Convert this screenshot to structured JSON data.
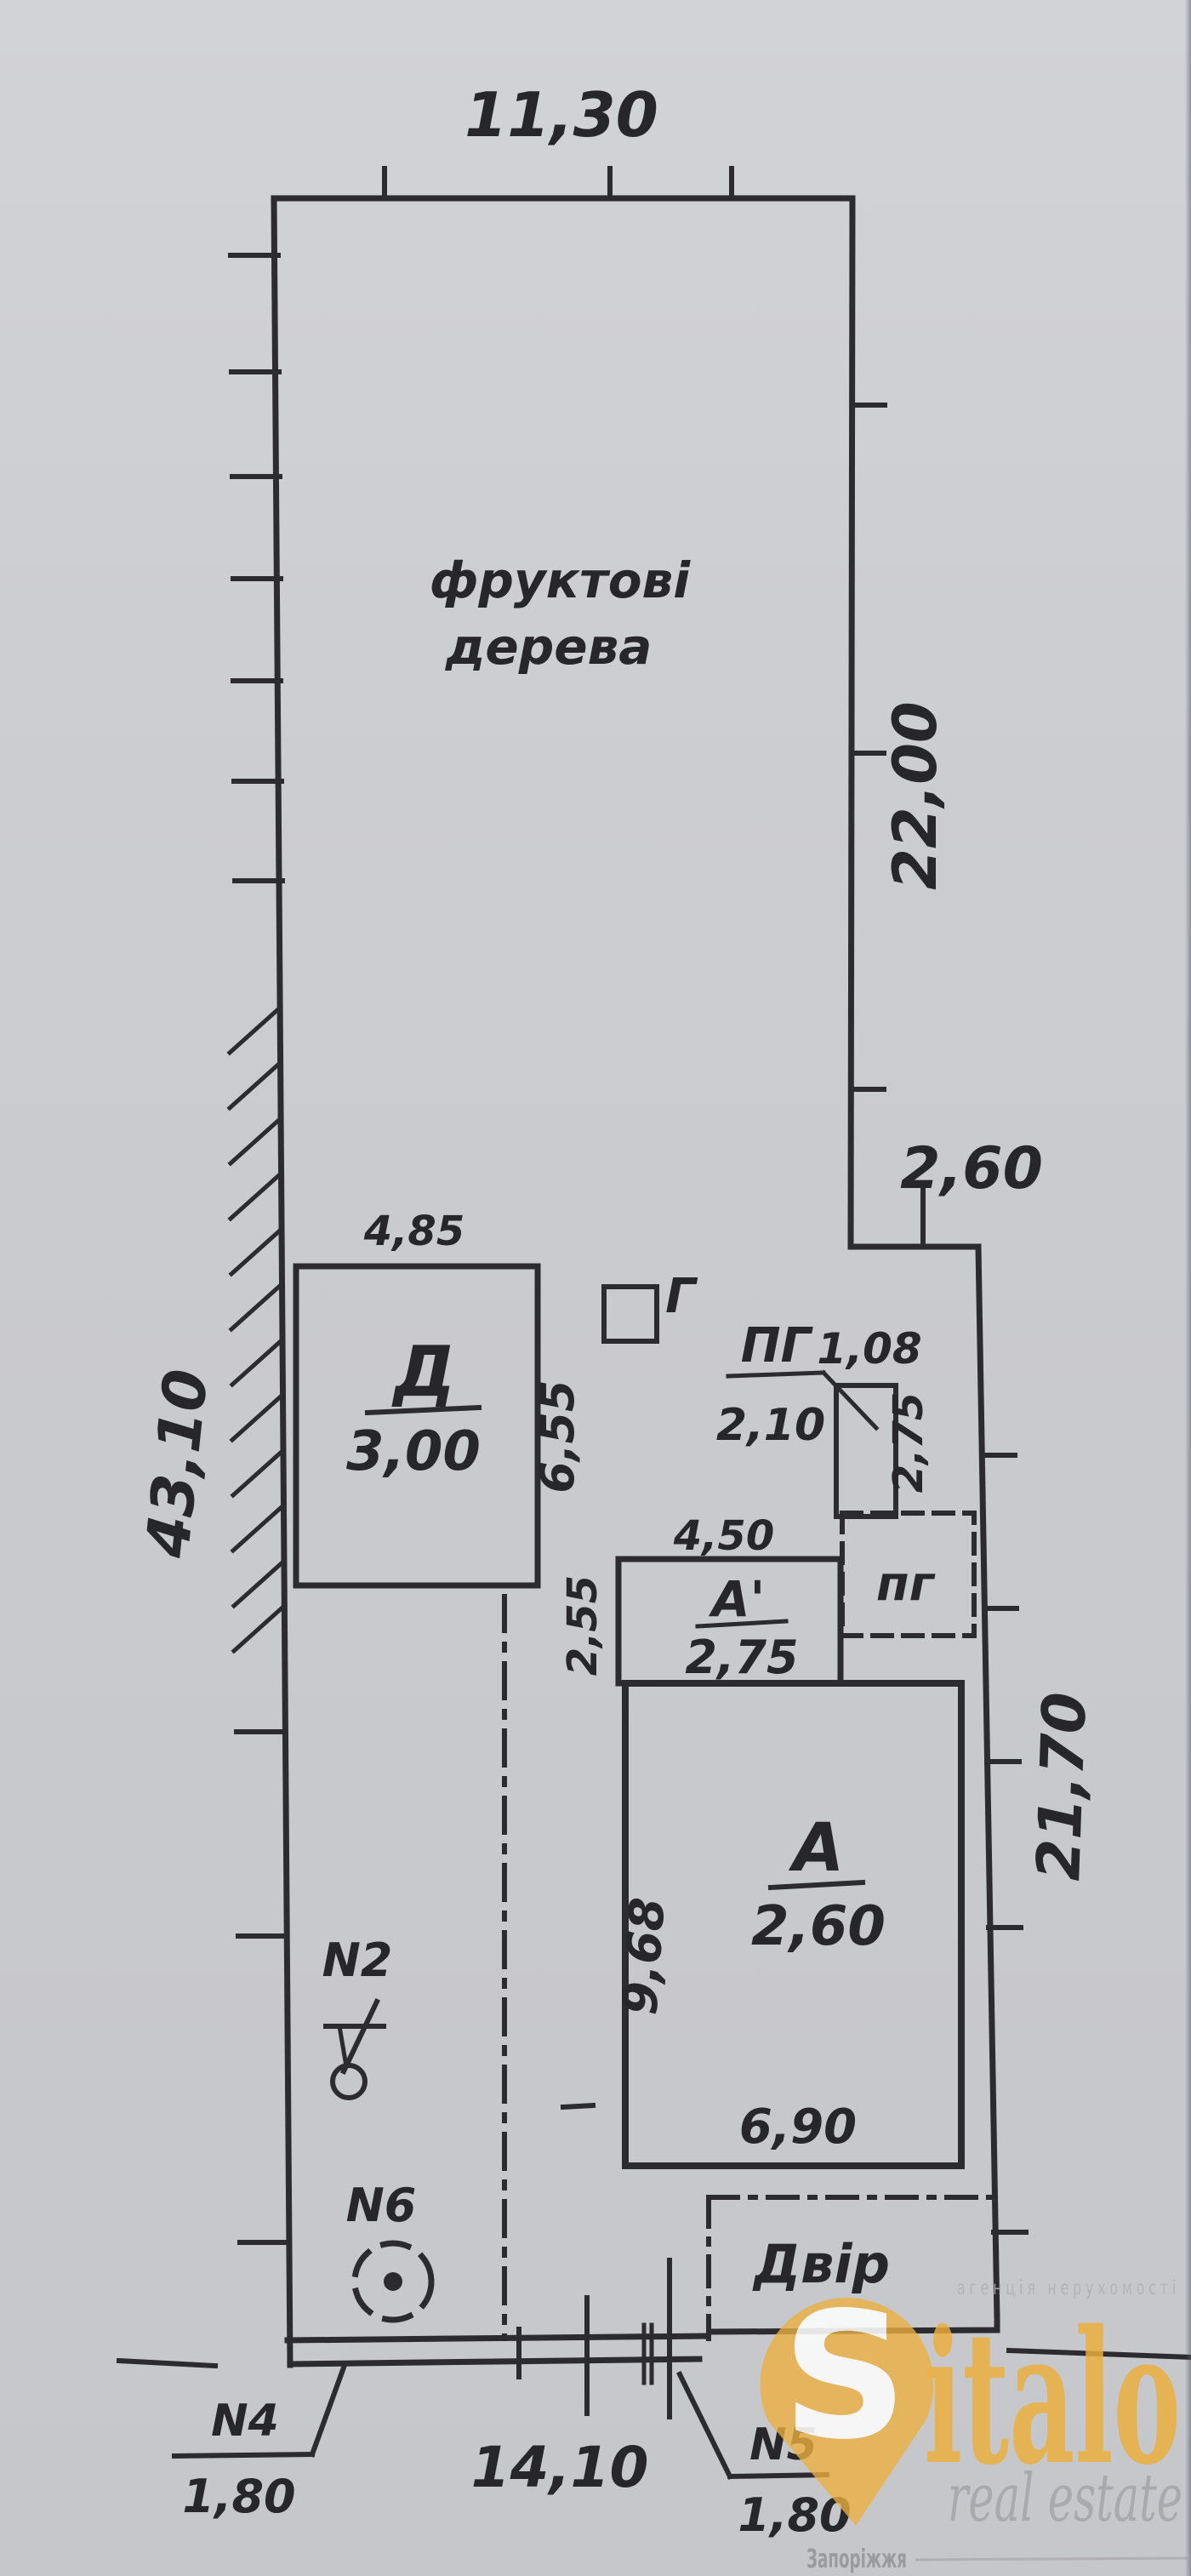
{
  "plan": {
    "dims": {
      "top_width": "11,30",
      "right_upper": "22,00",
      "step": "2,60",
      "left_length": "43,10",
      "right_lower": "21,70",
      "bottom_width": "14,10"
    },
    "garden": {
      "line1": "фруктові",
      "line2": "дерева"
    },
    "building_d": {
      "letter": "Д",
      "value": "3,00",
      "top_dim": "4,85",
      "side_dim": "6,55"
    },
    "building_g": {
      "letter": "Г"
    },
    "structure_pg": {
      "letter": "ПГ",
      "dim_a": "1,08",
      "dim_b": "2,10",
      "side_dim": "2,75"
    },
    "building_a1": {
      "letter": "А'",
      "value": "2,75",
      "top_dim": "4,50",
      "side_dim": "2,55"
    },
    "cellar_pg": {
      "letter": "пг"
    },
    "building_a": {
      "letter": "А",
      "value": "2,60",
      "bottom_dim": "6,90",
      "side_dim": "9,68"
    },
    "yard": {
      "label": "Двір"
    },
    "markers": {
      "n2": "N2",
      "n6": "N6"
    },
    "gates": {
      "n4": {
        "label": "N4",
        "width": "1,80"
      },
      "n5": {
        "label": "N5",
        "width": "1,80"
      }
    }
  },
  "watermark": {
    "s": "S",
    "name_rest": "italo",
    "agency_line": "агенція нерухомості",
    "subtitle": "real estate",
    "city": "Запоріжжя"
  }
}
